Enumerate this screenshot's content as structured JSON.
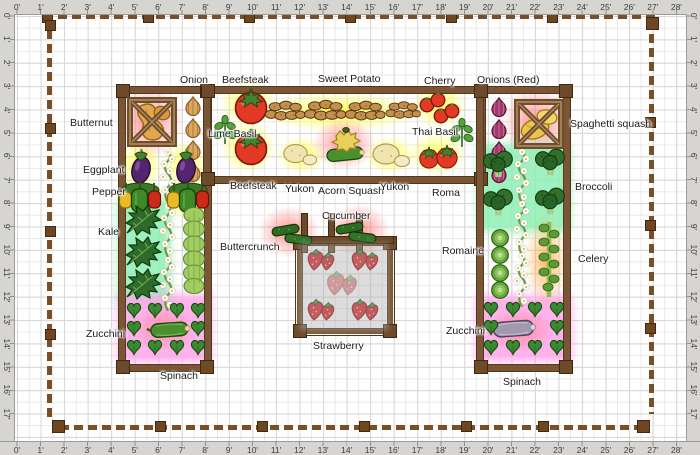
{
  "rulers": {
    "top": [
      "0'",
      "1'",
      "2'",
      "3'",
      "4'",
      "5'",
      "6'",
      "7'",
      "8'",
      "9'",
      "10'",
      "11'",
      "12'",
      "13'",
      "14'",
      "15'",
      "16'",
      "17'",
      "18'",
      "19'",
      "20'",
      "21'",
      "22'",
      "23'",
      "24'",
      "25'",
      "26'",
      "27'",
      "28'"
    ],
    "bottom": [
      "0'",
      "1'",
      "2'",
      "3'",
      "4'",
      "5'",
      "6'",
      "7'",
      "8'",
      "9'",
      "10'",
      "11'",
      "12'",
      "13'",
      "14'",
      "15'",
      "16'",
      "17'",
      "18'",
      "19'",
      "20'",
      "21'",
      "22'",
      "23'",
      "24'",
      "25'",
      "26'",
      "27'",
      "28'"
    ],
    "left": [
      "0'",
      "1'",
      "2'",
      "3'",
      "4'",
      "5'",
      "6'",
      "7'",
      "8'",
      "9'",
      "10'",
      "11'",
      "12'",
      "13'",
      "14'",
      "15'",
      "16'",
      "17'"
    ],
    "right": [
      "0'",
      "1'",
      "2'",
      "3'",
      "4'",
      "5'",
      "6'",
      "7'",
      "8'",
      "9'",
      "10'",
      "11'",
      "12'",
      "13'",
      "14'",
      "15'",
      "16'",
      "17'"
    ]
  },
  "plant_labels": {
    "onion": "Onion",
    "beefsteak_top": "Beefsteak",
    "sweet_potato": "Sweet Potato",
    "cherry": "Cherry",
    "onions_red": "Onions (Red)",
    "butternut": "Butternut",
    "lime_basil": "Lime Basil",
    "thai_basil": "Thai Basil",
    "spaghetti_squash": "Spaghetti squash",
    "eggplant": "Eggplant",
    "pepper": "Pepper",
    "kale": "Kale",
    "beefsteak_bottom": "Beefsteak",
    "yukon_left": "Yukon",
    "acorn_squash": "Acorn Squash",
    "yukon_right": "Yukon",
    "roma": "Roma",
    "broccoli": "Broccoli",
    "buttercrunch": "Buttercrunch",
    "cucumber": "Cucumber",
    "romaine": "Romaine",
    "celery": "Celery",
    "zucchini_left": "Zucchini",
    "zucchini_right": "Zucchini",
    "strawberry": "Strawberry",
    "spinach_left": "Spinach",
    "spinach_right": "Spinach"
  },
  "palette": {
    "bed_wood": "#7b5636",
    "fence_wood": "#7a4f28",
    "glow_yellow": "#ffff3c",
    "glow_pink": "#ff7d7d",
    "glow_orange": "#ffaa46",
    "zone_mint": "#8fefb4",
    "zone_pink": "#ffa6ea",
    "ruler_bg": "#d7d5d1",
    "grid_line": "#e9e9e9"
  }
}
